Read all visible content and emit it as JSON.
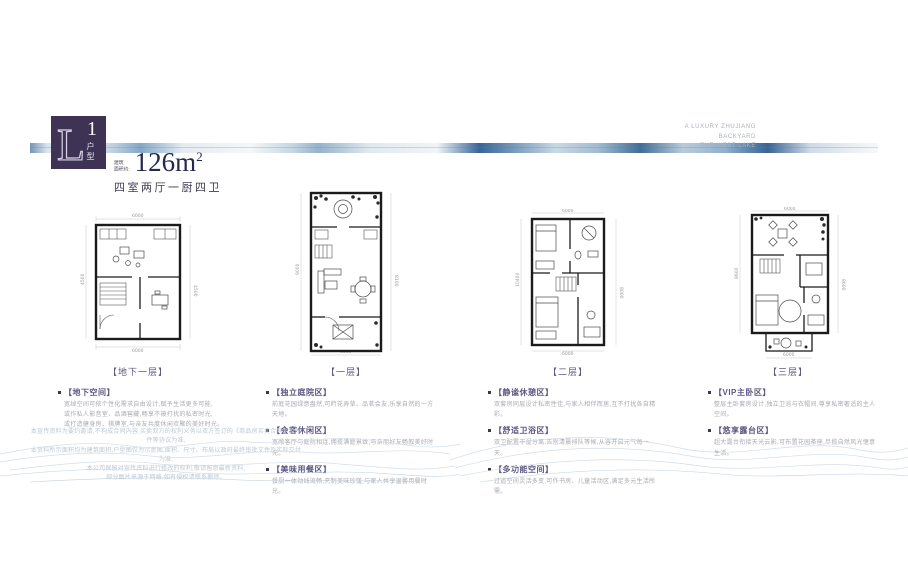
{
  "header": {
    "block_letter": "L",
    "block_number": "1",
    "block_suffix": "户型",
    "area_prefix_line1": "建筑",
    "area_prefix_line2": "面积约:",
    "area_value": "126m",
    "area_sup": "2",
    "layout_desc": "四室两厅一厨四卫",
    "tagline_line1": "A LUXURY ZHUJIANG",
    "tagline_line2": "BACKYARD",
    "tagline_line3": "THE WEST LAKE"
  },
  "plans": [
    {
      "caption": "【地下一层】",
      "dims": {
        "top": "6000",
        "bottom": "6000",
        "left": "4500",
        "right": "4500"
      },
      "sections": [
        {
          "title": "【地下空间】",
          "line1": "宽绰空间可依个性化需求自由设计,赋予生活更多可能,",
          "line2": "或作私人影音室、品酒窖藏,畅享不被打扰的私密时光,",
          "line3": "或打造健身房、棋牌室,与亲友共度休闲欢聚的美好时光。"
        }
      ]
    },
    {
      "caption": "【一层】",
      "dims": {
        "left": "9000",
        "right": "8100",
        "bottom": "6000"
      },
      "sections": [
        {
          "title": "【独立庭院区】",
          "line1": "前庭花园绿意盎然,可莳花弄草、品茗会友,乐享自然的一方天地。"
        },
        {
          "title": "【会客休闲区】",
          "line1": "宽敞客厅与庭院相连,拥揽满庭景致,与亲朋好友畅叙美好时光。"
        },
        {
          "title": "【美味用餐区】",
          "line1": "餐厨一体动线流畅,烹制美味珍馐,与家人共享温馨用餐时光。"
        }
      ]
    },
    {
      "caption": "【二层】",
      "dims": {
        "top": "6000",
        "bottom": "6000",
        "left": "10400",
        "right": "8000"
      },
      "sections": [
        {
          "title": "【静谧休憩区】",
          "line1": "双套房同层设计私密性佳,与家人相伴而居,互不打扰各自精彩。"
        },
        {
          "title": "【舒适卫浴区】",
          "line1": "双卫配置干湿分离,告别清晨排队等候,从容开启元气每一天。"
        },
        {
          "title": "【多功能空间】",
          "line1": "过道空间灵活多变,可作书房、儿童活动区,满足多元生活所需。"
        }
      ]
    },
    {
      "caption": "【三层】",
      "dims": {
        "top": "6000",
        "bottom": "6000",
        "left": "8600",
        "right": "8600"
      },
      "sections": [
        {
          "title": "【VIP主卧区】",
          "line1": "整层主卧套房设计,独立卫浴与衣帽间,尊享私密奢适的主人空间。"
        },
        {
          "title": "【悠享露台区】",
          "line1": "超大露台衔接天光云影,可布置花园茶座,尽揽自然风光惬意生活。"
        }
      ]
    }
  ],
  "disclaimer": {
    "line1": "本宣传资料为要约邀请,不构成合同内容,买卖双方的权利义务以双方签订的《商品房买卖合同》及附件等协议为准,",
    "line2": "本资料所示面积均为建筑面积,户型图仅为示意图,面积、尺寸、布局以政府最终审批文件及实际交付为准,",
    "line3": "本公司保留对宣传资料进行修改的权利,敬请留意最新资料,",
    "line4": "部分图片来源于网络,如有侵权请联系删除。"
  }
}
